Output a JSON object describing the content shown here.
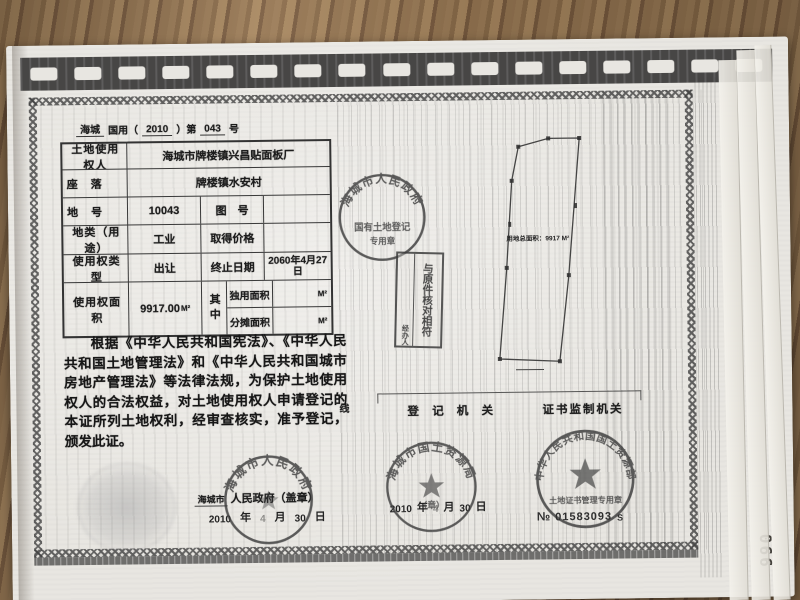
{
  "photo": {
    "page_number": "066"
  },
  "serial": {
    "region": "海城",
    "part1": "国用（",
    "year": "2010",
    "part2": "）第",
    "number": "043",
    "suffix": "号"
  },
  "table": {
    "rows": [
      {
        "label": "土地使用权人",
        "value": "海城市牌楼镇兴昌贴面板厂"
      },
      {
        "label": "座　落",
        "value": "牌楼镇水安村"
      },
      {
        "label": "地　号",
        "value": "10043",
        "label2": "图　号",
        "value2": ""
      },
      {
        "label": "地类（用途）",
        "value": "工业",
        "label2": "取得价格",
        "value2": ""
      },
      {
        "label": "使用权类型",
        "value": "出让",
        "label2": "终止日期",
        "value2": "2060年4月27日"
      },
      {
        "label": "使用权面积",
        "value": "9917.00",
        "unit": "M²",
        "group": "其中",
        "sub": [
          {
            "label": "独用面积",
            "value": "",
            "unit": "M²"
          },
          {
            "label": "分摊面积",
            "value": "",
            "unit": "M²"
          }
        ]
      }
    ]
  },
  "legal_text": "根据《中华人民共和国宪法》、《中华人民共和国土地管理法》和《中华人民共和国城市房地产管理法》等法律法规，为保护土地使用权人的合法权益，对土地使用权人申请登记的本证所列土地权利，经审查核实，准予登记，颁发此证。",
  "diagram": {
    "area_label": "用地总面积：9917 M²"
  },
  "verify_stamp": {
    "main": "与原件核对相符",
    "side": "经办人"
  },
  "seals": {
    "land_reg": {
      "ring": "海城市人民政府",
      "inner1": "国有土地登记",
      "inner2": "专用章"
    },
    "gov": {
      "ring": "海城市人民政府"
    },
    "bureau": {
      "ring": "海城市国土资源局",
      "inner": "（章）"
    },
    "ministry": {
      "ring": "中华人民共和国国土资源部",
      "inner": "土地证书管理专用章"
    }
  },
  "issuer": {
    "name": "海城市",
    "printed": "人民政府（盖章）",
    "date": {
      "y": "2010",
      "y_label": "年",
      "m": "4",
      "m_label": "月",
      "d": "30",
      "d_label": "日"
    }
  },
  "footer": {
    "thread_label": "线",
    "reg_org": "登 记 机 关",
    "sup_org": "证书监制机关",
    "reg_date": {
      "y": "2010",
      "y_label": "年",
      "m": "4",
      "m_label": "月",
      "d": "30",
      "d_label": "日"
    },
    "cert_no_prefix": "№",
    "cert_no": "01583093",
    "cert_no_suffix": "S"
  }
}
